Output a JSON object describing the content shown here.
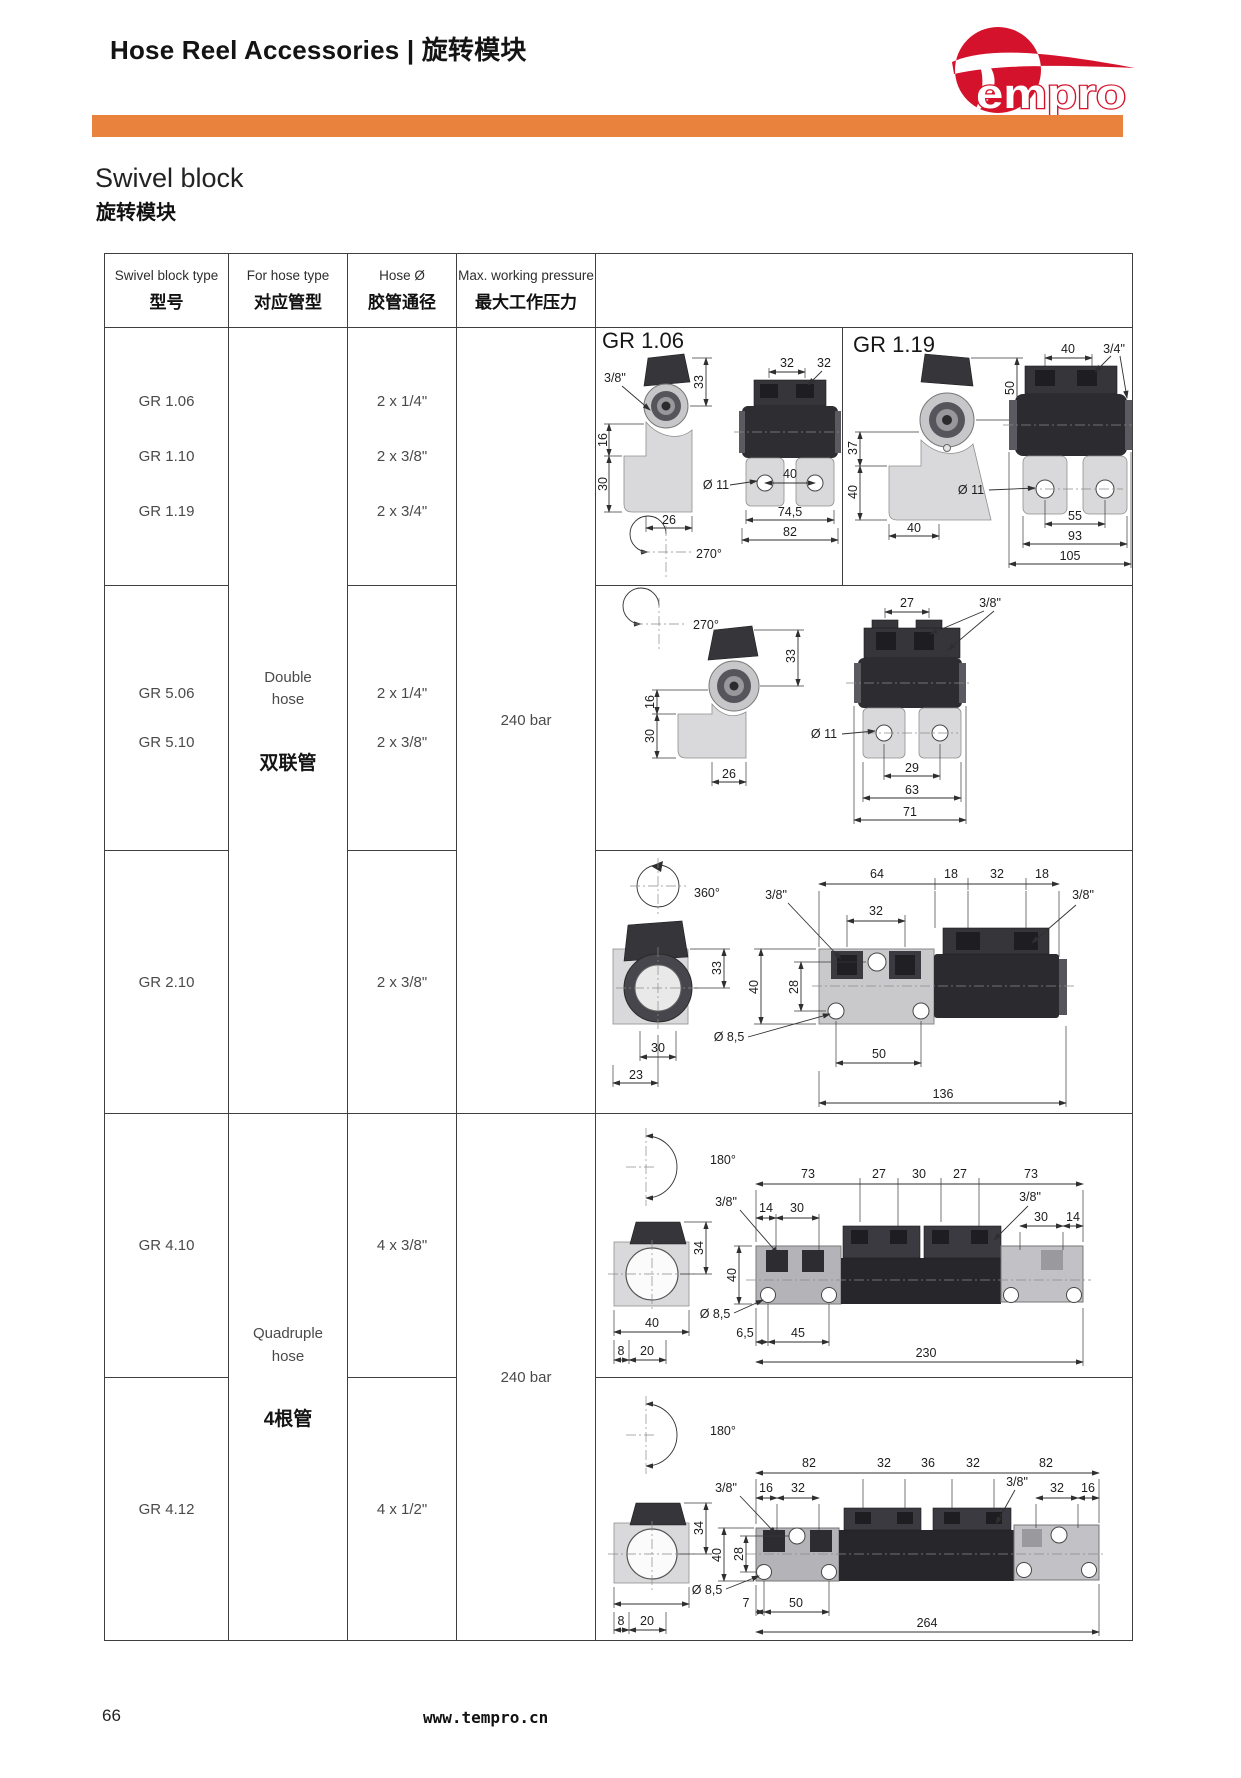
{
  "page": {
    "header_title": "Hose Reel Accessories | 旋转模块",
    "logo_text": "empro",
    "section_title_en": "Swivel block",
    "section_title_zh": "旋转模块",
    "footer_page": "66",
    "footer_site": "www.tempro.cn",
    "accent_orange": "#e8823c",
    "brand_red": "#d5122b"
  },
  "table": {
    "headers": [
      {
        "en": "Swivel block type",
        "zh": "型号"
      },
      {
        "en": "For hose type",
        "zh": "对应管型"
      },
      {
        "en": "Hose Ø",
        "zh": "胶管通径"
      },
      {
        "en": "Max. working pressure",
        "zh": "最大工作压力"
      }
    ],
    "groups": [
      {
        "models": [
          "GR 1.06",
          "GR 1.10",
          "GR 1.19"
        ],
        "hose": [
          "2 x 1/4\"",
          "2 x 3/8\"",
          "2 x 3/4\""
        ]
      },
      {
        "models": [
          "GR 5.06",
          "GR 5.10"
        ],
        "hose": [
          "2 x 1/4\"",
          "2 x 3/8\""
        ]
      },
      {
        "models": [
          "GR 2.10"
        ],
        "hose": [
          "2 x 3/8\""
        ]
      },
      {
        "models": [
          "GR 4.10"
        ],
        "hose": [
          "4 x 3/8\""
        ]
      },
      {
        "models": [
          "GR 4.12"
        ],
        "hose": [
          "4 x 1/2\""
        ]
      }
    ],
    "hose_types": [
      {
        "en": "Double hose",
        "zh": "双联管"
      },
      {
        "en": "Quadruple hose",
        "zh": "4根管"
      }
    ],
    "pressures": [
      "240 bar",
      "240 bar"
    ]
  },
  "drawings": {
    "d1a": {
      "label": "GR 1.06",
      "thread": "3/8\"",
      "rot": "270°",
      "t32a": "32",
      "t32b": "32",
      "v33": "33",
      "v16": "16",
      "v30": "30",
      "b26": "26",
      "dia": "Ø 11",
      "b40": "40",
      "b745": "74,5",
      "b82": "82"
    },
    "d1b": {
      "label": "GR 1.19",
      "thread": "3/4\"",
      "t40": "40",
      "v50": "50",
      "v37": "37",
      "v40": "40",
      "b40": "40",
      "dia": "Ø 11",
      "b55": "55",
      "b93": "93",
      "b105": "105"
    },
    "d2": {
      "rot": "270°",
      "thread": "3/8\"",
      "t27": "27",
      "v33": "33",
      "v16": "16",
      "v30": "30",
      "b26": "26",
      "dia": "Ø 11",
      "b29": "29",
      "b63": "63",
      "b71": "71"
    },
    "d3": {
      "rot": "360°",
      "threadL": "3/8\"",
      "threadR": "3/8\"",
      "t64": "64",
      "t18a": "18",
      "t32": "32",
      "t18b": "18",
      "p32": "32",
      "v33": "33",
      "v40": "40",
      "v28": "28",
      "dia": "Ø 8,5",
      "b30": "30",
      "b23": "23",
      "b50": "50",
      "b136": "136"
    },
    "d4": {
      "rot": "180°",
      "threadL": "3/8\"",
      "threadR": "3/8\"",
      "t73a": "73",
      "t27a": "27",
      "t30": "30",
      "t27b": "27",
      "t73b": "73",
      "s14a": "14",
      "s30a": "30",
      "s30b": "30",
      "s14b": "14",
      "v34": "34",
      "v40": "40",
      "dia": "Ø 8,5",
      "b40": "40",
      "b8": "8",
      "b20": "20",
      "b65": "6,5",
      "b45": "45",
      "b230": "230"
    },
    "d5": {
      "rot": "180°",
      "threadL": "3/8\"",
      "threadR": "3/8\"",
      "t82a": "82",
      "t32a": "32",
      "t36": "36",
      "t32b": "32",
      "t82b": "82",
      "s16a": "16",
      "s32a": "32",
      "s32b": "32",
      "s16b": "16",
      "v34": "34",
      "v40": "40",
      "v28": "28",
      "dia": "Ø 8,5",
      "b7": "7",
      "b50": "50",
      "b8": "8",
      "b20": "20",
      "b264": "264"
    }
  }
}
